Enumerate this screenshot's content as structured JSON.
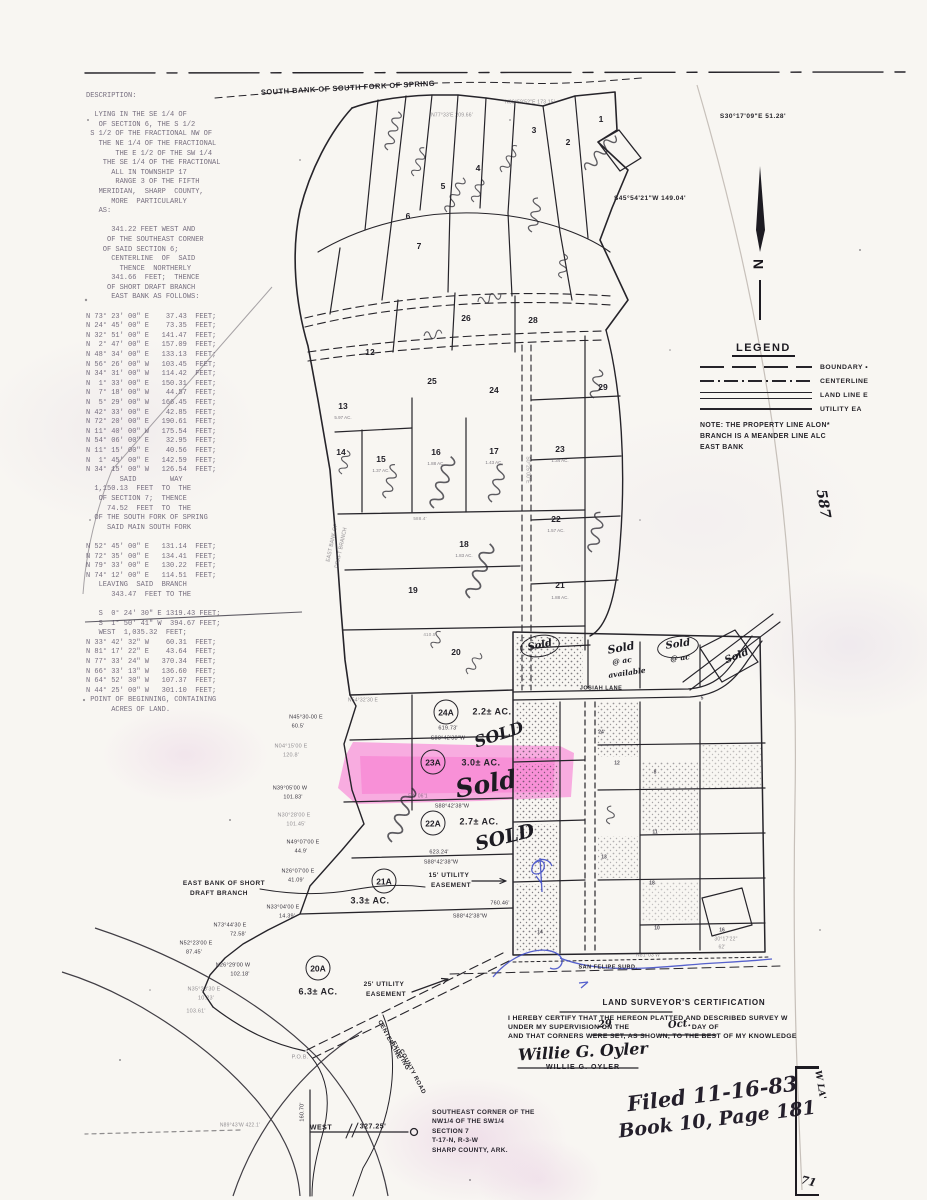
{
  "document": {
    "top_boundary_label": "SOUTH BANK OF SOUTH FORK OF SPRING",
    "north_label": "N",
    "legend": {
      "title": "LEGEND",
      "items": [
        {
          "label": "BOUNDARY •"
        },
        {
          "label": "CENTERLINE"
        },
        {
          "label": "LAND LINE E"
        },
        {
          "label": "UTILITY EA"
        }
      ]
    },
    "note_lines": [
      "NOTE: THE PROPERTY LINE ALON*",
      "BRANCH IS A MEANDER LINE ALC",
      "EAST BANK"
    ],
    "corner_note_lines": [
      "SOUTHEAST CORNER OF THE",
      "NW1/4 OF THE SW1/4",
      "SECTION 7",
      "T-17-N, R-3-W",
      "SHARP COUNTY, ARK."
    ],
    "filed_lines": [
      "Filed 11-16-83",
      "Book 10, Page 181"
    ],
    "margin_box": {
      "vertical_text": "W  LA'",
      "number": "71"
    }
  },
  "certification": {
    "heading": "LAND SURVEYOR'S CERTIFICATION",
    "line1": "I HEREBY CERTIFY THAT THE HEREON PLATTED  AND DESCRIBED SURVEY  W",
    "line2_pre": "UNDER MY SUPERVISION ON THE",
    "line2_mid": "DAY OF",
    "day": "29",
    "month": "Oct.",
    "line3": "AND THAT CORNERS WERE SET, AS SHOWN, TO THE BEST OF MY KNOWLEDGE",
    "signature": "Willie G. Oyler",
    "typed_name": "WILLIE G. OYLER"
  },
  "parcels": [
    {
      "id": "24A",
      "acreage": "2.2± AC.",
      "sold": "SOLD",
      "cx": 446,
      "cy": 712,
      "ax": 492,
      "ay": 712,
      "sx": 499,
      "sy": 735,
      "ss": 16,
      "sr": -18,
      "highlighted": false
    },
    {
      "id": "23A",
      "acreage": "3.0± AC.",
      "sold": "Sold",
      "cx": 433,
      "cy": 762,
      "ax": 481,
      "ay": 763,
      "sx": 486,
      "sy": 784,
      "ss": 25,
      "sr": -10,
      "highlighted": true
    },
    {
      "id": "22A",
      "acreage": "2.7± AC.",
      "sold": "SOLD",
      "cx": 433,
      "cy": 823,
      "ax": 479,
      "ay": 822,
      "sx": 505,
      "sy": 838,
      "ss": 19,
      "sr": -14,
      "highlighted": false
    },
    {
      "id": "21A",
      "acreage": "3.3± AC.",
      "sold": "",
      "cx": 384,
      "cy": 881,
      "ax": 370,
      "ay": 901,
      "highlighted": false
    },
    {
      "id": "20A",
      "acreage": "6.3± AC.",
      "sold": "",
      "cx": 318,
      "cy": 968,
      "ax": 318,
      "ay": 992,
      "highlighted": false
    }
  ],
  "map": {
    "colors": {
      "highlight": "#ff3fcf",
      "blue_pen": "#3947c6",
      "ink": "#26242a",
      "paper": "#f8f6f2"
    },
    "ellipses": [
      {
        "x": 540,
        "y": 646,
        "w": 38,
        "h": 20,
        "r": -10
      },
      {
        "x": 678,
        "y": 647,
        "w": 40,
        "h": 20,
        "r": -8
      }
    ],
    "stamps": [
      {
        "t": "SOUTH BANK OF SOUTH FORK OF SPRING",
        "x": 348,
        "y": 88,
        "s": 7.5,
        "r": -3,
        "c": "t"
      },
      {
        "t": "N69°59'52\"E 173.15'",
        "x": 530,
        "y": 103,
        "s": 5,
        "c": "b f"
      },
      {
        "t": "N77°33'E 209.66'",
        "x": 452,
        "y": 116,
        "s": 5,
        "c": "b f"
      },
      {
        "t": "S30°17'09\"E  51.28'",
        "x": 753,
        "y": 117,
        "s": 6.5,
        "c": "t"
      },
      {
        "t": "S45°54'21\"W 149.04'",
        "x": 650,
        "y": 199,
        "s": 6.5,
        "c": "t"
      },
      {
        "t": "587",
        "x": 823,
        "y": 504,
        "s": 14,
        "r": 80,
        "c": "h"
      },
      {
        "t": "JOSIAH LANE",
        "x": 601,
        "y": 689,
        "s": 5.5,
        "c": "t"
      },
      {
        "t": "SAN FELIPE SUBD.",
        "x": 608,
        "y": 968,
        "s": 5.5,
        "c": "t"
      },
      {
        "t": "EAST BANK OF SHORT",
        "x": 224,
        "y": 884,
        "s": 6.5,
        "c": "t"
      },
      {
        "t": "DRAFT BRANCH",
        "x": 219,
        "y": 894,
        "s": 6.5,
        "c": "t"
      },
      {
        "t": "15' UTILITY",
        "x": 449,
        "y": 876,
        "s": 6.5,
        "c": "t"
      },
      {
        "t": "EASEMENT",
        "x": 451,
        "y": 886,
        "s": 6.5,
        "c": "t"
      },
      {
        "t": "25' UTILITY",
        "x": 384,
        "y": 985,
        "s": 6.5,
        "c": "t"
      },
      {
        "t": "EASEMENT",
        "x": 386,
        "y": 995,
        "s": 6.5,
        "c": "t"
      },
      {
        "t": "CENTERLINE",
        "x": 389,
        "y": 1040,
        "s": 6,
        "r": 62,
        "c": "t"
      },
      {
        "t": "EXISTING",
        "x": 400,
        "y": 1056,
        "s": 6,
        "r": 62,
        "c": "t"
      },
      {
        "t": "COUNTY ROAD",
        "x": 412,
        "y": 1072,
        "s": 6,
        "r": 62,
        "c": "t"
      },
      {
        "t": "WEST",
        "x": 321,
        "y": 1128,
        "s": 7,
        "c": "t"
      },
      {
        "t": "327.25'",
        "x": 373,
        "y": 1127,
        "s": 7,
        "c": "t"
      },
      {
        "t": "160.70'",
        "x": 303,
        "y": 1112,
        "s": 5.5,
        "r": -90,
        "c": "b"
      },
      {
        "t": "N89°43'W 422.1'",
        "x": 240,
        "y": 1126,
        "s": 5,
        "c": "b f"
      },
      {
        "t": "P.O.B.",
        "x": 300,
        "y": 1058,
        "s": 5.5,
        "c": "b f"
      },
      {
        "t": "S0°25'00\"E",
        "x": 527,
        "y": 470,
        "s": 5,
        "r": 90,
        "c": "b f"
      },
      {
        "t": "EAST BANK OF",
        "x": 333,
        "y": 543,
        "s": 5,
        "r": -78,
        "c": "b f"
      },
      {
        "t": "DRAFT BRANCH",
        "x": 342,
        "y": 548,
        "s": 5,
        "r": -78,
        "c": "b f"
      },
      {
        "t": "619.73'",
        "x": 448,
        "y": 729,
        "s": 5.5,
        "c": "b"
      },
      {
        "t": "S88°42'38\"W",
        "x": 448,
        "y": 739,
        "s": 5.5,
        "c": "b"
      },
      {
        "t": "S88°42'38\"W",
        "x": 452,
        "y": 807,
        "s": 5.5,
        "c": "b"
      },
      {
        "t": "5W 06'1",
        "x": 418,
        "y": 797,
        "s": 5,
        "c": "b f"
      },
      {
        "t": "623.24'",
        "x": 439,
        "y": 853,
        "s": 5.5,
        "c": "b"
      },
      {
        "t": "S88°42'38\"W",
        "x": 441,
        "y": 863,
        "s": 5.5,
        "c": "b"
      },
      {
        "t": "760.46'",
        "x": 500,
        "y": 904,
        "s": 5.5,
        "c": "b"
      },
      {
        "t": "S88°42'38\"W",
        "x": 470,
        "y": 917,
        "s": 5.5,
        "c": "b"
      },
      {
        "t": "N26°07'00 E",
        "x": 298,
        "y": 872,
        "s": 5.5,
        "c": "b"
      },
      {
        "t": "41.09'",
        "x": 296,
        "y": 881,
        "s": 5.5,
        "c": "b"
      },
      {
        "t": "N33°04'00 E",
        "x": 283,
        "y": 908,
        "s": 5.5,
        "c": "b"
      },
      {
        "t": "14.39'",
        "x": 287,
        "y": 917,
        "s": 5.5,
        "c": "b"
      },
      {
        "t": "N73°44'30 E",
        "x": 230,
        "y": 926,
        "s": 5.5,
        "c": "b"
      },
      {
        "t": "72.58'",
        "x": 238,
        "y": 935,
        "s": 5.5,
        "c": "b"
      },
      {
        "t": "N52°23'00 E",
        "x": 196,
        "y": 944,
        "s": 5.5,
        "c": "b"
      },
      {
        "t": "87.45'",
        "x": 194,
        "y": 953,
        "s": 5.5,
        "c": "b"
      },
      {
        "t": "N26°29'00 W",
        "x": 233,
        "y": 966,
        "s": 5.5,
        "c": "b"
      },
      {
        "t": "102.18'",
        "x": 240,
        "y": 975,
        "s": 5.5,
        "c": "b"
      },
      {
        "t": "N35°23'30 E",
        "x": 204,
        "y": 990,
        "s": 5.5,
        "c": "b f"
      },
      {
        "t": "10.23'",
        "x": 206,
        "y": 999,
        "s": 5.5,
        "c": "b f"
      },
      {
        "t": "103.61'",
        "x": 196,
        "y": 1012,
        "s": 5.5,
        "c": "b f"
      },
      {
        "t": "N45°30-00 E",
        "x": 306,
        "y": 718,
        "s": 5.5,
        "c": "b"
      },
      {
        "t": "60.5'",
        "x": 298,
        "y": 727,
        "s": 5.5,
        "c": "b"
      },
      {
        "t": "N04°15'00 E",
        "x": 291,
        "y": 747,
        "s": 5.5,
        "c": "b f"
      },
      {
        "t": "120.8'",
        "x": 291,
        "y": 756,
        "s": 5.5,
        "c": "b f"
      },
      {
        "t": "N39°05'00 W",
        "x": 290,
        "y": 789,
        "s": 5.5,
        "c": "b"
      },
      {
        "t": "101.83'",
        "x": 293,
        "y": 798,
        "s": 5.5,
        "c": "b"
      },
      {
        "t": "N30°28'00 E",
        "x": 294,
        "y": 816,
        "s": 5.5,
        "c": "b f"
      },
      {
        "t": "101.45'",
        "x": 296,
        "y": 825,
        "s": 5.5,
        "c": "b f"
      },
      {
        "t": "N49°07'00 E",
        "x": 303,
        "y": 843,
        "s": 5.5,
        "c": "b"
      },
      {
        "t": "44.9'",
        "x": 301,
        "y": 852,
        "s": 5.5,
        "c": "b"
      },
      {
        "t": "N54°32'30 E",
        "x": 363,
        "y": 701,
        "s": 5,
        "c": "b f"
      },
      {
        "t": "588.4'",
        "x": 420,
        "y": 519,
        "s": 4.5,
        "c": "b f"
      },
      {
        "t": "410.5'",
        "x": 430,
        "y": 635,
        "s": 4.5,
        "c": "b f"
      },
      {
        "t": "30°17'22\"",
        "x": 726,
        "y": 940,
        "s": 5,
        "c": "b f"
      },
      {
        "t": "62'",
        "x": 722,
        "y": 948,
        "s": 5,
        "c": "b f"
      },
      {
        "t": "N81°03'W",
        "x": 648,
        "y": 956,
        "s": 5,
        "c": "b f"
      },
      {
        "t": "1",
        "x": 601,
        "y": 119,
        "s": 8.5,
        "c": "l"
      },
      {
        "t": "2",
        "x": 568,
        "y": 142,
        "s": 8.5,
        "c": "l"
      },
      {
        "t": "3",
        "x": 534,
        "y": 130,
        "s": 8.5,
        "c": "l"
      },
      {
        "t": "4",
        "x": 478,
        "y": 168,
        "s": 8.5,
        "c": "l"
      },
      {
        "t": "5",
        "x": 443,
        "y": 186,
        "s": 8.5,
        "c": "l"
      },
      {
        "t": "6",
        "x": 408,
        "y": 216,
        "s": 8.5,
        "c": "l"
      },
      {
        "t": "7",
        "x": 419,
        "y": 246,
        "s": 8.5,
        "c": "l"
      },
      {
        "t": "12",
        "x": 370,
        "y": 352,
        "s": 8.5,
        "c": "l"
      },
      {
        "t": "13",
        "x": 343,
        "y": 406,
        "s": 8.5,
        "c": "l"
      },
      {
        "t": "14",
        "x": 341,
        "y": 452,
        "s": 8.5,
        "c": "l"
      },
      {
        "t": "15",
        "x": 381,
        "y": 459,
        "s": 8.5,
        "c": "l"
      },
      {
        "t": "16",
        "x": 436,
        "y": 452,
        "s": 8.5,
        "c": "l"
      },
      {
        "t": "17",
        "x": 494,
        "y": 451,
        "s": 8.5,
        "c": "l"
      },
      {
        "t": "18",
        "x": 464,
        "y": 544,
        "s": 8.5,
        "c": "l"
      },
      {
        "t": "19",
        "x": 413,
        "y": 590,
        "s": 8.5,
        "c": "l"
      },
      {
        "t": "20",
        "x": 456,
        "y": 652,
        "s": 8.5,
        "c": "l"
      },
      {
        "t": "21",
        "x": 560,
        "y": 585,
        "s": 8.5,
        "c": "l"
      },
      {
        "t": "22",
        "x": 556,
        "y": 519,
        "s": 8.5,
        "c": "l"
      },
      {
        "t": "23",
        "x": 560,
        "y": 449,
        "s": 8.5,
        "c": "l"
      },
      {
        "t": "24",
        "x": 494,
        "y": 390,
        "s": 8.5,
        "c": "l"
      },
      {
        "t": "25",
        "x": 432,
        "y": 381,
        "s": 8.5,
        "c": "l"
      },
      {
        "t": "26",
        "x": 466,
        "y": 318,
        "s": 8.5,
        "c": "l"
      },
      {
        "t": "28",
        "x": 533,
        "y": 320,
        "s": 8.5,
        "c": "l"
      },
      {
        "t": "29",
        "x": 603,
        "y": 387,
        "s": 8.5,
        "c": "l"
      },
      {
        "t": "5.97 AC.",
        "x": 343,
        "y": 418,
        "s": 4.5,
        "c": "a"
      },
      {
        "t": "1.37 AC.",
        "x": 381,
        "y": 471,
        "s": 4.5,
        "c": "a"
      },
      {
        "t": "1.88 AC.",
        "x": 436,
        "y": 464,
        "s": 4.5,
        "c": "a"
      },
      {
        "t": "1.43 AC.",
        "x": 494,
        "y": 463,
        "s": 4.5,
        "c": "a"
      },
      {
        "t": "1.83 AC.",
        "x": 464,
        "y": 556,
        "s": 4.5,
        "c": "a"
      },
      {
        "t": "1.57 AC.",
        "x": 556,
        "y": 531,
        "s": 4.5,
        "c": "a"
      },
      {
        "t": "1.34 AC.",
        "x": 560,
        "y": 461,
        "s": 4.5,
        "c": "a"
      },
      {
        "t": "1.88 AC.",
        "x": 560,
        "y": 598,
        "s": 4.5,
        "c": "a"
      },
      {
        "t": "24",
        "x": 601,
        "y": 733,
        "s": 5,
        "c": "g"
      },
      {
        "t": "12",
        "x": 617,
        "y": 764,
        "s": 5,
        "c": "g"
      },
      {
        "t": "8",
        "x": 655,
        "y": 773,
        "s": 5,
        "c": "g"
      },
      {
        "t": "11",
        "x": 655,
        "y": 833,
        "s": 5,
        "c": "g"
      },
      {
        "t": "13",
        "x": 604,
        "y": 858,
        "s": 5,
        "c": "g"
      },
      {
        "t": "18",
        "x": 652,
        "y": 884,
        "s": 5,
        "c": "g"
      },
      {
        "t": "10",
        "x": 657,
        "y": 929,
        "s": 5,
        "c": "g"
      },
      {
        "t": "14",
        "x": 540,
        "y": 933,
        "s": 5,
        "c": "g"
      },
      {
        "t": "5",
        "x": 702,
        "y": 699,
        "s": 5,
        "c": "g"
      },
      {
        "t": "16",
        "x": 722,
        "y": 931,
        "s": 5,
        "c": "g"
      },
      {
        "t": "Sold",
        "x": 540,
        "y": 646,
        "s": 10,
        "r": -12,
        "c": "h"
      },
      {
        "t": "Sold",
        "x": 621,
        "y": 648,
        "s": 11,
        "r": -10,
        "c": "h"
      },
      {
        "t": "@ ac",
        "x": 622,
        "y": 661,
        "s": 7.5,
        "r": -8,
        "c": "h"
      },
      {
        "t": "available",
        "x": 627,
        "y": 673,
        "s": 7.5,
        "r": -8,
        "c": "h"
      },
      {
        "t": "Sold",
        "x": 678,
        "y": 645,
        "s": 10,
        "r": -8,
        "c": "h"
      },
      {
        "t": "@ ac",
        "x": 680,
        "y": 658,
        "s": 7.5,
        "r": -6,
        "c": "h"
      },
      {
        "t": "Sold",
        "x": 737,
        "y": 657,
        "s": 10,
        "r": -22,
        "c": "h"
      }
    ]
  },
  "left_description": {
    "lines": [
      "DESCRIPTION:",
      "",
      "  LYING IN THE SE 1/4 OF",
      "   OF SECTION 6, THE S 1/2",
      " S 1/2 OF THE FRACTIONAL NW OF",
      "   THE NE 1/4 OF THE FRACTIONAL",
      "       THE E 1/2 OF THE SW 1/4",
      "    THE SE 1/4 OF THE FRACTIONAL",
      "      ALL IN TOWNSHIP 17",
      "       RANGE 3 OF THE FIFTH",
      "   MERIDIAN,  SHARP  COUNTY,",
      "      MORE  PARTICULARLY",
      "   AS:",
      "",
      "      341.22 FEET WEST AND",
      "     OF THE SOUTHEAST CORNER",
      "    OF SAID SECTION 6;",
      "      CENTERLINE  OF  SAID",
      "        THENCE  NORTHERLY",
      "      341.66  FEET;  THENCE",
      "     OF SHORT DRAFT BRANCH",
      "      EAST BANK AS FOLLOWS:",
      "",
      "N 73° 23' 00\" E    37.43  FEET;",
      "N 24° 45' 00\" E    73.35  FEET;",
      "N 32° 51' 00\" E   141.47  FEET;",
      "N  2° 47' 00\" E   157.09  FEET;",
      "N 48° 34' 00\" E   133.13  FEET;",
      "N 56° 26' 00\" W   103.45  FEET;",
      "N 34° 31' 00\" W   114.42  FEET;",
      "N  1° 33' 00\" E   150.31  FEET;",
      "N  7° 18' 00\" W    44.57  FEET;",
      "N  5° 29' 00\" W   166.45  FEET;",
      "N 42° 33' 00\" E    42.85  FEET;",
      "N 72° 20' 00\" E   190.61  FEET;",
      "N 11° 40' 00\" W   175.54  FEET;",
      "N 54° 06' 00\" E    32.95  FEET;",
      "N 11° 15' 00\" E    40.56  FEET;",
      "N  1° 45' 00\" E   142.59  FEET;",
      "N 34° 15' 00\" W   126.54  FEET;",
      "        SAID        WAY",
      "  1,150.13  FEET  TO  THE",
      "   OF SECTION 7;  THENCE",
      "     74.52  FEET  TO  THE",
      "  OF THE SOUTH FORK OF SPRING",
      "     SAID MAIN SOUTH FORK",
      "",
      "N 52° 45' 00\" E   131.14  FEET;",
      "N 72° 35' 00\" E   134.41  FEET;",
      "N 79° 33' 00\" E   130.22  FEET;",
      "N 74° 12' 00\" E   114.51  FEET;",
      "   LEAVING  SAID  BRANCH",
      "      343.47  FEET TO THE",
      "",
      "   S  0° 24' 30\" E 1319.43 FEET;",
      "   S  1° 50' 41\" W  394.67 FEET;",
      "   WEST  1,035.32  FEET;",
      "N 33° 42' 32\" W    60.31  FEET;",
      "N 81° 17' 22\" E    43.64  FEET;",
      "N 77° 33' 24\" W   370.34  FEET;",
      "N 66° 33' 13\" W   136.60  FEET;",
      "N 64° 52' 30\" W   107.37  FEET;",
      "N 44° 25' 00\" W   301.10  FEET;",
      " POINT OF BEGINNING, CONTAINING",
      "      ACRES OF LAND."
    ]
  }
}
